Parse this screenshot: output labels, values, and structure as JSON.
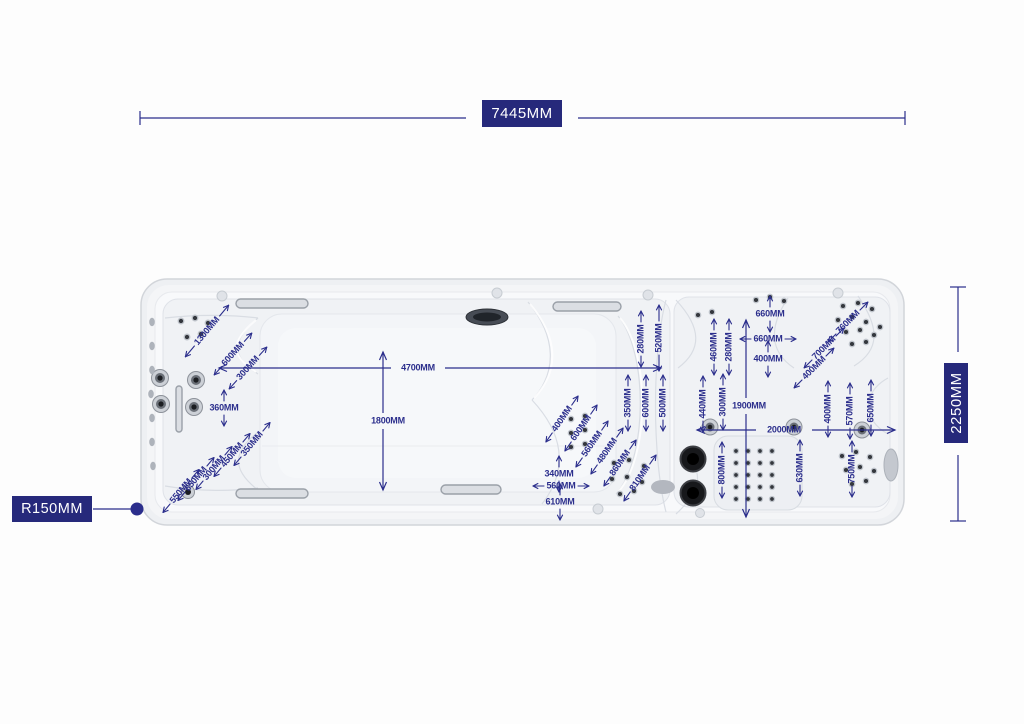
{
  "colors": {
    "dimension": "#2b2e8c",
    "label_box_bg": "#26297b",
    "label_box_text": "#ffffff",
    "shell": "#eef0f3",
    "surface": "#f8f9fb"
  },
  "overall": {
    "length_label": "7445MM",
    "width_label": "2250MM",
    "radius_label": "R150MM"
  },
  "annotations": [
    {
      "label": "1300MM",
      "x": 207,
      "y": 331,
      "r": -50,
      "a": "par",
      "len": 14
    },
    {
      "label": "600MM",
      "x": 233,
      "y": 354,
      "r": -48,
      "a": "par"
    },
    {
      "label": "300MM",
      "x": 248,
      "y": 368,
      "r": -48,
      "a": "par"
    },
    {
      "label": "360MM",
      "x": 224,
      "y": 408,
      "r": 0,
      "a": "v"
    },
    {
      "label": "350MM",
      "x": 252,
      "y": 444,
      "r": -50,
      "a": "par"
    },
    {
      "label": "450MM",
      "x": 232,
      "y": 455,
      "r": -50,
      "a": "par"
    },
    {
      "label": "300MM",
      "x": 214,
      "y": 468,
      "r": -50,
      "a": "par"
    },
    {
      "label": "650MM",
      "x": 196,
      "y": 479,
      "r": -50,
      "a": "par"
    },
    {
      "label": "550MM",
      "x": 181,
      "y": 491,
      "r": -50,
      "a": "par"
    },
    {
      "label": "4700MM",
      "x": 418,
      "y": 368,
      "r": 0,
      "a": "none"
    },
    {
      "label": "1800MM",
      "x": 388,
      "y": 421,
      "r": 0,
      "a": "none"
    },
    {
      "label": "280MM",
      "x": 641,
      "y": 339,
      "r": -90,
      "a": "par"
    },
    {
      "label": "520MM",
      "x": 659,
      "y": 338,
      "r": -90,
      "a": "par",
      "len": 16
    },
    {
      "label": "350MM",
      "x": 628,
      "y": 403,
      "r": -90,
      "a": "par"
    },
    {
      "label": "600MM",
      "x": 646,
      "y": 403,
      "r": -90,
      "a": "par"
    },
    {
      "label": "500MM",
      "x": 663,
      "y": 403,
      "r": -90,
      "a": "par"
    },
    {
      "label": "400MM",
      "x": 562,
      "y": 419,
      "r": -55,
      "a": "par"
    },
    {
      "label": "600MM",
      "x": 581,
      "y": 428,
      "r": -55,
      "a": "par"
    },
    {
      "label": "560MM",
      "x": 592,
      "y": 444,
      "r": -55,
      "a": "par"
    },
    {
      "label": "480MM",
      "x": 607,
      "y": 451,
      "r": -55,
      "a": "par"
    },
    {
      "label": "860MM",
      "x": 620,
      "y": 463,
      "r": -55,
      "a": "par"
    },
    {
      "label": "810MM",
      "x": 640,
      "y": 478,
      "r": -55,
      "a": "par"
    },
    {
      "label": "340MM",
      "x": 559,
      "y": 474,
      "r": 0,
      "a": "v"
    },
    {
      "label": "560MM",
      "x": 561,
      "y": 486,
      "r": 0,
      "a": "h"
    },
    {
      "label": "610MM",
      "x": 560,
      "y": 502,
      "r": 0,
      "a": "v"
    },
    {
      "label": "460MM",
      "x": 714,
      "y": 347,
      "r": -90,
      "a": "par"
    },
    {
      "label": "280MM",
      "x": 729,
      "y": 347,
      "r": -90,
      "a": "par"
    },
    {
      "label": "660MM",
      "x": 770,
      "y": 314,
      "r": 0,
      "a": "v"
    },
    {
      "label": "660MM",
      "x": 768,
      "y": 339,
      "r": 0,
      "a": "h"
    },
    {
      "label": "400MM",
      "x": 768,
      "y": 359,
      "r": 0,
      "a": "v"
    },
    {
      "label": "440MM",
      "x": 703,
      "y": 404,
      "r": -90,
      "a": "par"
    },
    {
      "label": "300MM",
      "x": 723,
      "y": 402,
      "r": -90,
      "a": "par"
    },
    {
      "label": "1900MM",
      "x": 749,
      "y": 406,
      "r": 0,
      "a": "none"
    },
    {
      "label": "2000MM",
      "x": 784,
      "y": 430,
      "r": 0,
      "a": "none"
    },
    {
      "label": "760MM",
      "x": 848,
      "y": 322,
      "r": -45,
      "a": "par"
    },
    {
      "label": "700MM",
      "x": 824,
      "y": 348,
      "r": -45,
      "a": "par"
    },
    {
      "label": "400MM",
      "x": 814,
      "y": 368,
      "r": -45,
      "a": "par"
    },
    {
      "label": "400MM",
      "x": 828,
      "y": 409,
      "r": -90,
      "a": "par"
    },
    {
      "label": "570MM",
      "x": 850,
      "y": 411,
      "r": -90,
      "a": "par"
    },
    {
      "label": "650MM",
      "x": 871,
      "y": 408,
      "r": -90,
      "a": "par"
    },
    {
      "label": "800MM",
      "x": 722,
      "y": 470,
      "r": -90,
      "a": "par"
    },
    {
      "label": "630MM",
      "x": 800,
      "y": 468,
      "r": -90,
      "a": "par"
    },
    {
      "label": "750MM",
      "x": 852,
      "y": 469,
      "r": -90,
      "a": "par"
    }
  ]
}
